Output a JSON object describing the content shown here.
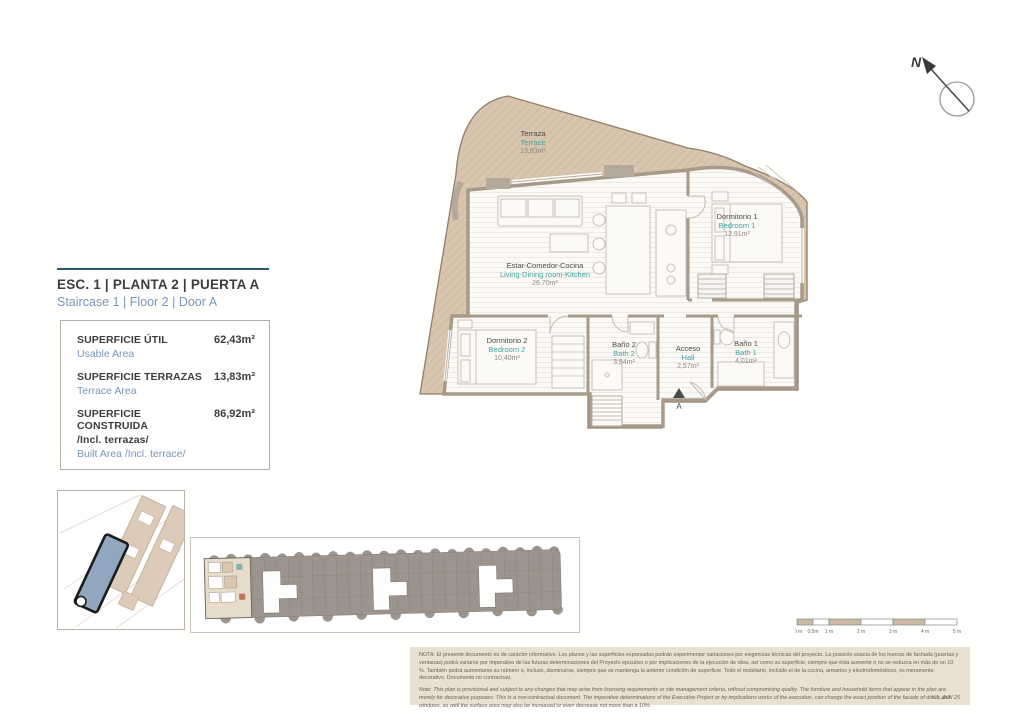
{
  "north_arrow": {
    "label": "N"
  },
  "title_block": {
    "title": "ESC. 1 | PLANTA 2 | PUERTA A",
    "subtitle": "Staircase 1 | Floor 2 | Door A",
    "accent_color": "#2c5871"
  },
  "area_table": {
    "rows": [
      {
        "label_es": "SUPERFICIE ÚTIL",
        "label_en": "Usable Area",
        "value": "62,43m²"
      },
      {
        "label_es": "SUPERFICIE TERRAZAS",
        "label_en": "Terrace Area",
        "value": "13,83m²"
      },
      {
        "label_es": "SUPERFICIE CONSTRUIDA",
        "label_es2": "/Incl. terrazas/",
        "label_en": "Built Area /Incl. terrace/",
        "value": "86,92m²"
      }
    ]
  },
  "floor_plan": {
    "rooms": [
      {
        "id": "terrace",
        "name_es": "Terraza",
        "name_en": "Terrace",
        "area": "13,83m²"
      },
      {
        "id": "living",
        "name_es": "Estar-Comedor-Cocina",
        "name_en": "Living-Dining room-Kitchen",
        "area": "26,70m²"
      },
      {
        "id": "bedroom1",
        "name_es": "Dormitorio 1",
        "name_en": "Bedroom 1",
        "area": "12,91m²"
      },
      {
        "id": "bedroom2",
        "name_es": "Dormitorio 2",
        "name_en": "Bedroom 2",
        "area": "10,40m²"
      },
      {
        "id": "bath2",
        "name_es": "Baño 2",
        "name_en": "Bath 2",
        "area": "3,84m²"
      },
      {
        "id": "hall",
        "name_es": "Acceso",
        "name_en": "Hall",
        "area": "2,57m²"
      },
      {
        "id": "bath1",
        "name_es": "Baño 1",
        "name_en": "Bath 1",
        "area": "4,01m²"
      }
    ],
    "entrance_label": "A",
    "colors": {
      "terrace_fill": "#d8c5ad",
      "wall": "#a89a8b",
      "label_es": "#4b4b49",
      "label_en": "#3fa39f",
      "label_area": "#8d8982",
      "site_highlight": "#91a7bf",
      "strip_gray": "#9d958d"
    }
  },
  "scale_bar": {
    "labels": [
      "0 m",
      "0,5m",
      "1 m",
      "2 m",
      "3 m",
      "4 m",
      "5 m"
    ]
  },
  "disclaimer": {
    "note_es": "NOTA: El presente documento es de carácter informativo. Los planos y las superficies expresadas podrán experimentar variaciones por exigencias técnicas del proyecto. La posición exacta de los huecos de fachada (puertas y ventanas) podrá variarse por imperativo de las futuras determinaciones del Proyecto ejecutivo o por implicaciones de la ejecución de obra, así como su superficie, siempre que ésta aumente o no se reduzca en más de un 10 %. También podrá aumentarse su número o, incluso, disminuirse, siempre que se mantenga la anterior condición de superficie. Todo el mobiliario, incluido el de la cocina, armarios y electrodomésticos, es meramente decorativo. Documento no contractual.",
    "note_en": "Note: This plan is provisional and subject to any changes that may arise from licensing requirements or site management criteria, without compromising quality. The furniture and household items that appear in the plan are merely for decorative purposes. This is a non-contractual document. The imperative determinations of the Executive Project or by implications works of the execution, can change the exact position of the facade of doors and windows, as well the surface area may also be increased or even decrease not more than a 10%.",
    "version": "V.1_JUN 25"
  }
}
